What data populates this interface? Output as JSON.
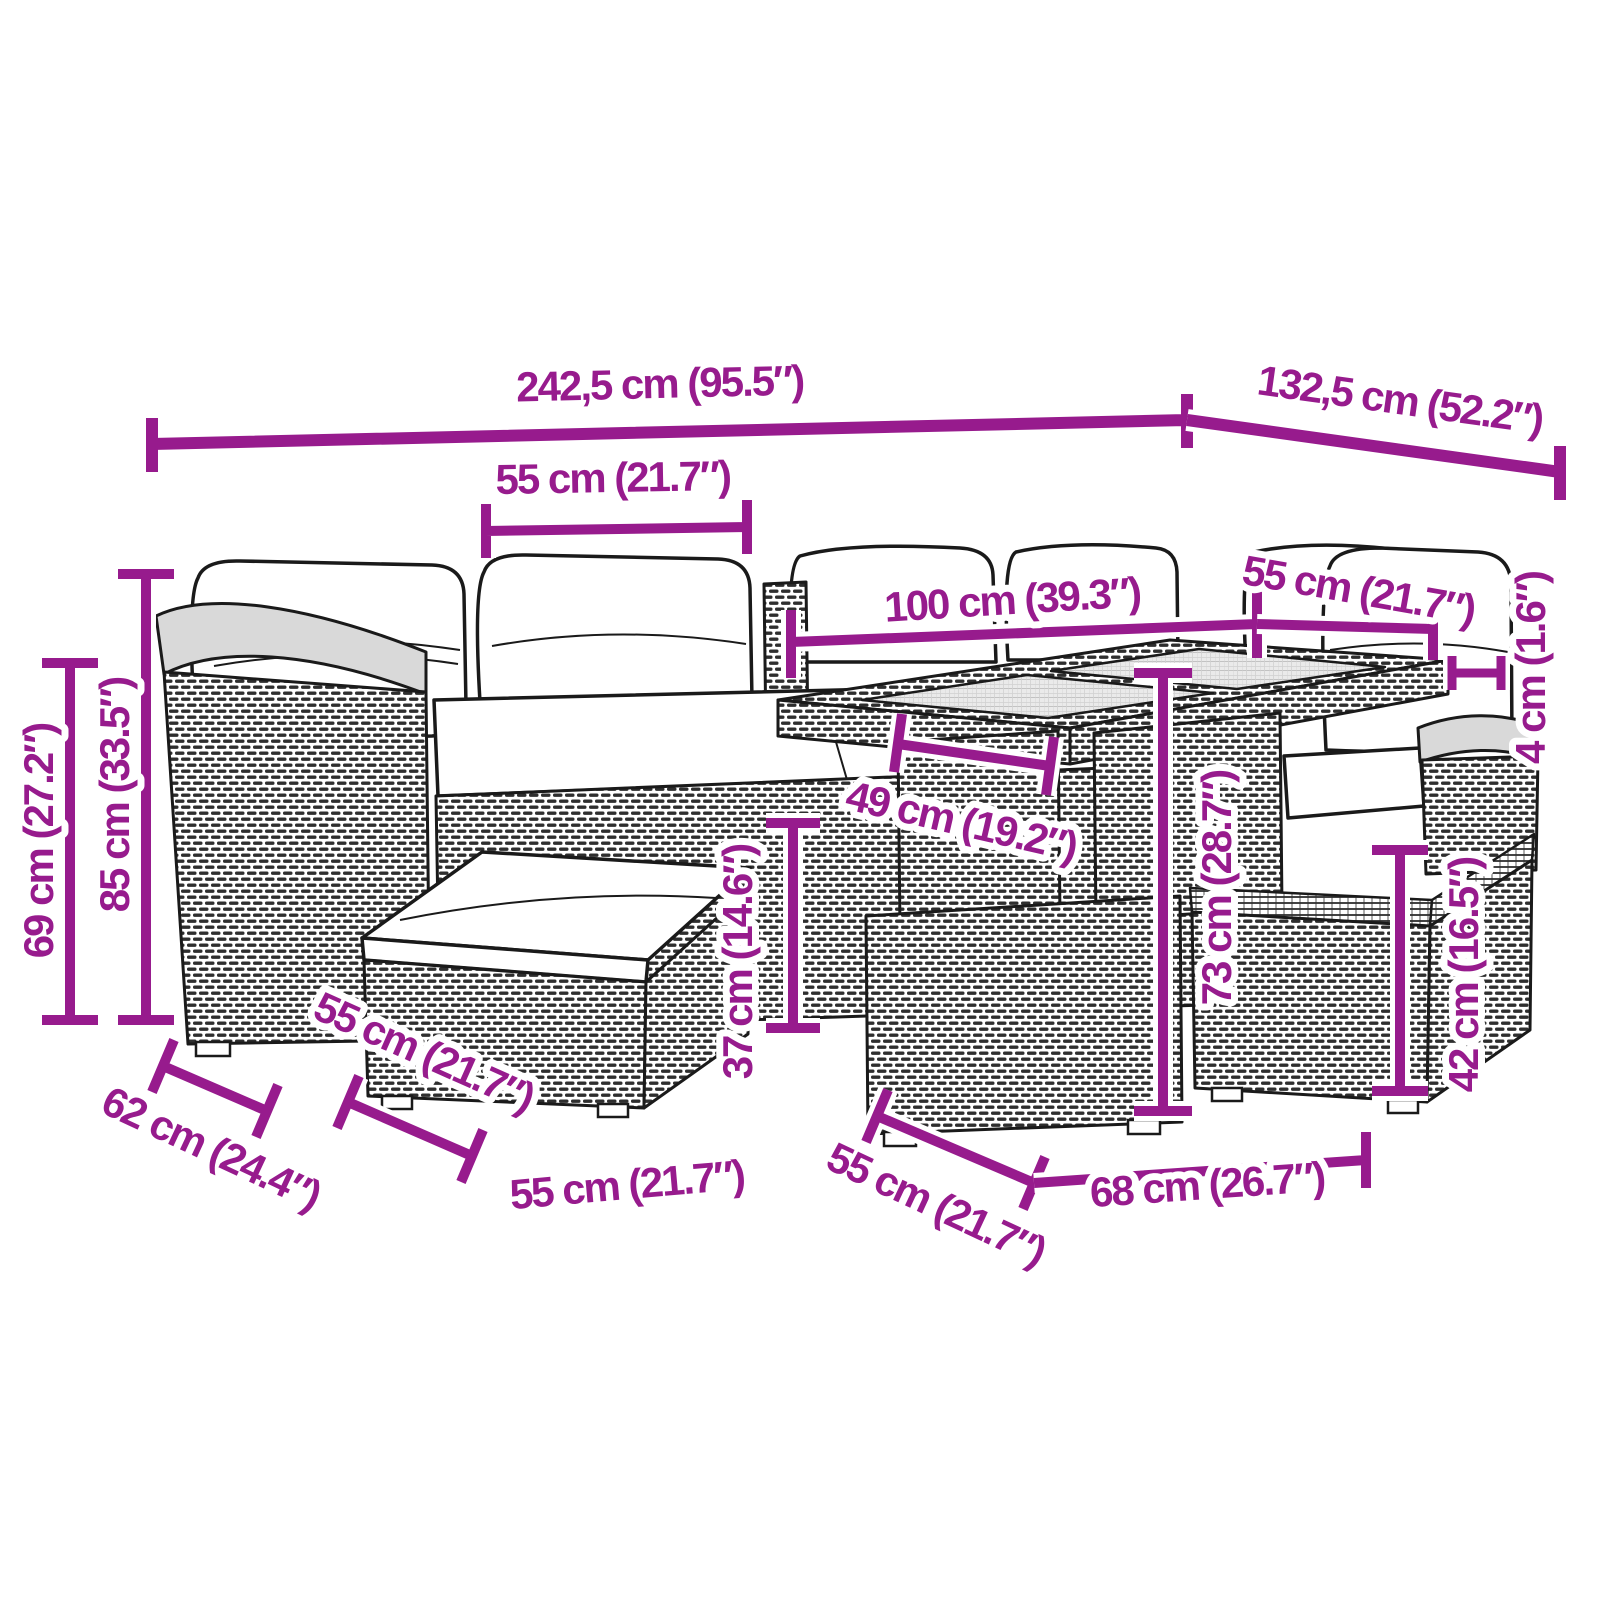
{
  "diagram": {
    "kind": "furniture-dimension-diagram",
    "subject": "rattan garden lounge set with corner sofa, cushions, footstools and glass-top table",
    "accent_color": "#971B8D",
    "linework_color": "#1a1a1a",
    "background_color": "#ffffff"
  },
  "dimensions": {
    "overall_width": "242,5 cm (95.5″)",
    "overall_depth": "132,5 cm (52.2″)",
    "sofa_module_width": "55 cm (21.7″)",
    "table_length": "100 cm (39.3″)",
    "right_module_width": "55 cm (21.7″)",
    "tabletop_thickness": "4 cm (1.6″)",
    "armrest_height": "69 cm (27.2″)",
    "backrest_height": "85 cm (33.5″)",
    "pedestal_width": "49 cm (19.2″)",
    "seat_height": "37 cm (14.6″)",
    "table_height": "73 cm (28.7″)",
    "ottoman_height": "42 cm (16.5″)",
    "sofa_depth": "62 cm (24.4″)",
    "stool_top_depth": "55 cm (21.7″)",
    "stool_width": "55 cm (21.7″)",
    "ottoman_depth": "55 cm (21.7″)",
    "ottoman_width": "68 cm (26.7″)"
  }
}
